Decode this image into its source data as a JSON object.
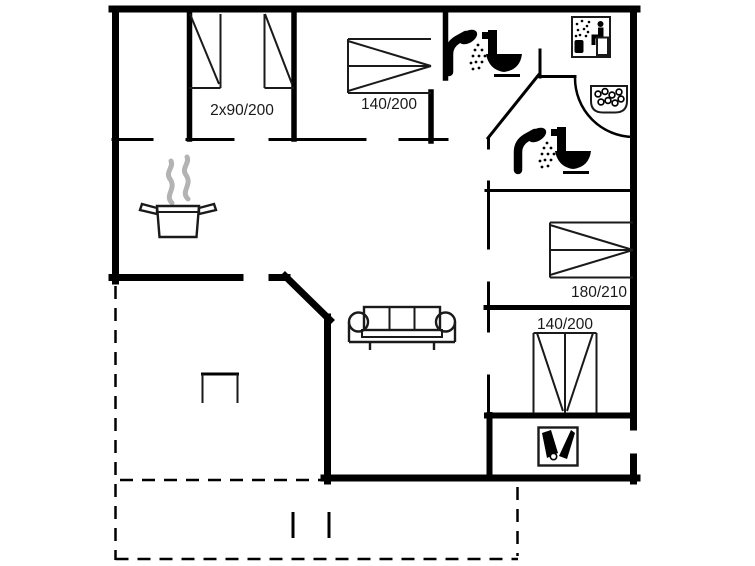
{
  "colors": {
    "wall": "#000000",
    "bg": "#ffffff",
    "steam": "#b3b3b3",
    "text": "#1a1a1a"
  },
  "beds": [
    {
      "name": "twin-beds",
      "label": "2x90/200"
    },
    {
      "name": "double-bed-top",
      "label": "140/200"
    },
    {
      "name": "double-bed-right",
      "label": "180/210"
    },
    {
      "name": "double-bed-bottom",
      "label": "140/200"
    }
  ],
  "icons": [
    {
      "name": "shower-icon-1",
      "meaning": "shower"
    },
    {
      "name": "toilet-icon-1",
      "meaning": "toilet"
    },
    {
      "name": "sauna-icon",
      "meaning": "sauna"
    },
    {
      "name": "whirlpool-icon",
      "meaning": "whirlpool"
    },
    {
      "name": "shower-icon-2",
      "meaning": "shower"
    },
    {
      "name": "toilet-icon-2",
      "meaning": "toilet"
    },
    {
      "name": "cooking-pot-icon",
      "meaning": "kitchen"
    },
    {
      "name": "sofa-icon",
      "meaning": "living room"
    },
    {
      "name": "utility-icon",
      "meaning": "utility room"
    }
  ]
}
